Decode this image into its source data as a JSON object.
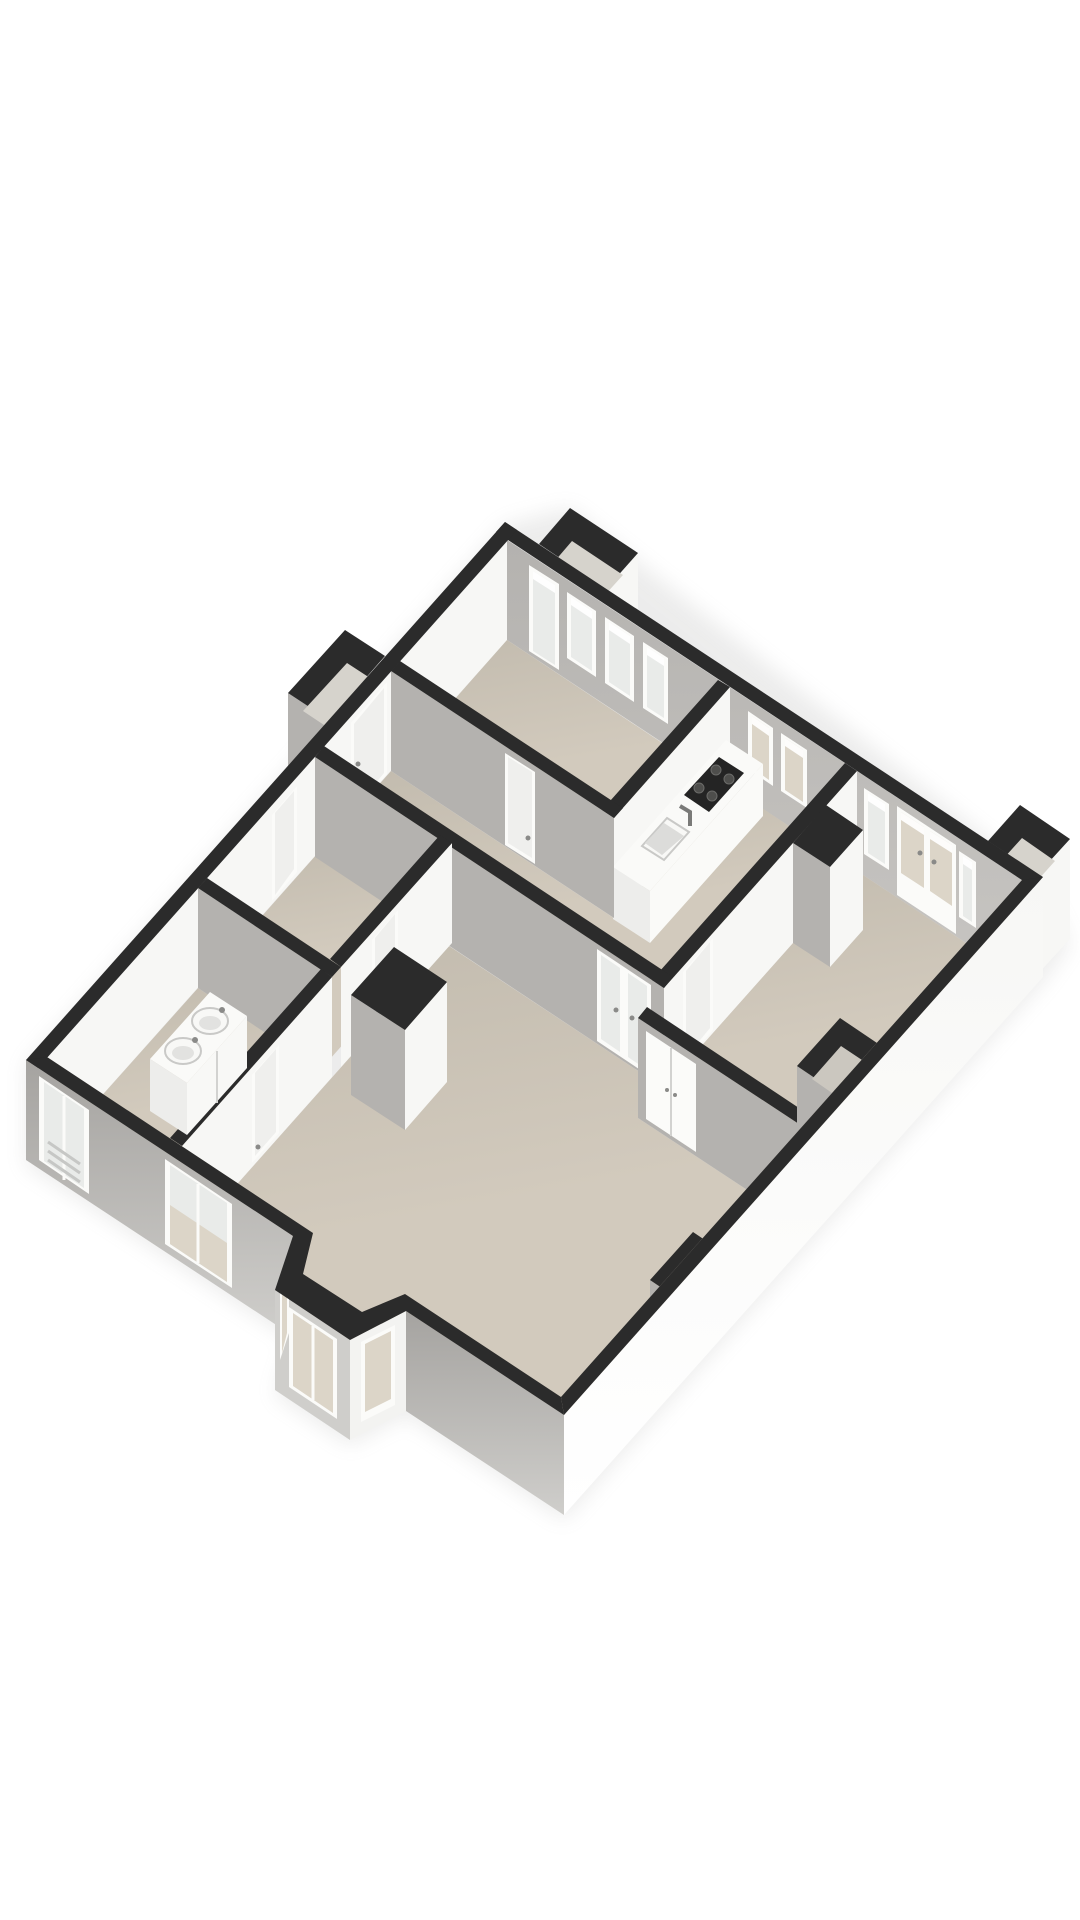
{
  "scene": {
    "label": "isometric 3D floor plan of an apartment on white background",
    "type": "3d-floor-plan",
    "rooms": [
      {
        "id": "bedroom-1",
        "position": "top",
        "floor": "beige",
        "openings": [
          "glazed-door",
          "window",
          "window",
          "window"
        ]
      },
      {
        "id": "kitchen",
        "position": "center-right",
        "floor": "beige",
        "fixtures": [
          "counter",
          "cooktop",
          "sink-with-faucet"
        ],
        "openings": [
          "window",
          "window"
        ]
      },
      {
        "id": "bedroom-2",
        "position": "right",
        "floor": "beige",
        "fixtures": [
          "duct-shaft",
          "closet-doors",
          "wall-niche"
        ],
        "openings": [
          "window",
          "french-doors",
          "window"
        ]
      },
      {
        "id": "hall",
        "position": "center",
        "floor": "beige",
        "fixtures": [
          "closet-box"
        ],
        "openings": [
          "front-door",
          "service-door",
          "bedroom-doors"
        ]
      },
      {
        "id": "toilet",
        "position": "center-left",
        "floor": "beige",
        "openings": [
          "door"
        ]
      },
      {
        "id": "bathroom",
        "position": "left",
        "floor": "beige",
        "fixtures": [
          "vanity",
          "vessel-sink",
          "vessel-sink"
        ],
        "openings": [
          "door",
          "window-with-radiator"
        ]
      },
      {
        "id": "living-room",
        "position": "bottom",
        "floor": "beige",
        "fixtures": [
          "window-niche"
        ],
        "openings": [
          "interior-french-doors",
          "window",
          "bay-window-3-panes"
        ]
      }
    ],
    "exterior_features": [
      "chimney-box-top",
      "chimney-box-right",
      "entrance-porch",
      "bay-window"
    ],
    "window_count": 14,
    "sink_count": 3
  },
  "colors": {
    "bg": "#ffffff",
    "wall_top": "#2b2b2b",
    "face_white": "#f7f7f5",
    "face_gray": "#b4b2af",
    "ext_gray": "#a5a3a0",
    "ext_light": "#cfcecb",
    "face_bright": "#f3f3f1",
    "floor_a": "#d2cabd",
    "floor_b": "#c2bbae",
    "frame": "#fbfbf9",
    "glass_cool": "#e9ebe9",
    "glass_warm": "#dcd5c8",
    "glow": "#ffffff",
    "panel": "#efefed",
    "counter": "#fafaf8",
    "counter_side": "#ededeb",
    "basin": "#dcdcda",
    "fixture": "#f8f8f6",
    "fixture_rim": "#c9c9c7",
    "fixture_inner": "#e2e2e0",
    "cooktop": "#242424",
    "burner": "#4e4e4c",
    "handle": "#8a8a88",
    "divider": "#d2d2d0",
    "radiator": "#c6c7c5",
    "chimney_floor": "#d6d3cc",
    "niche_floor": "#cbc7bf",
    "shadow": "#9a9a98"
  }
}
